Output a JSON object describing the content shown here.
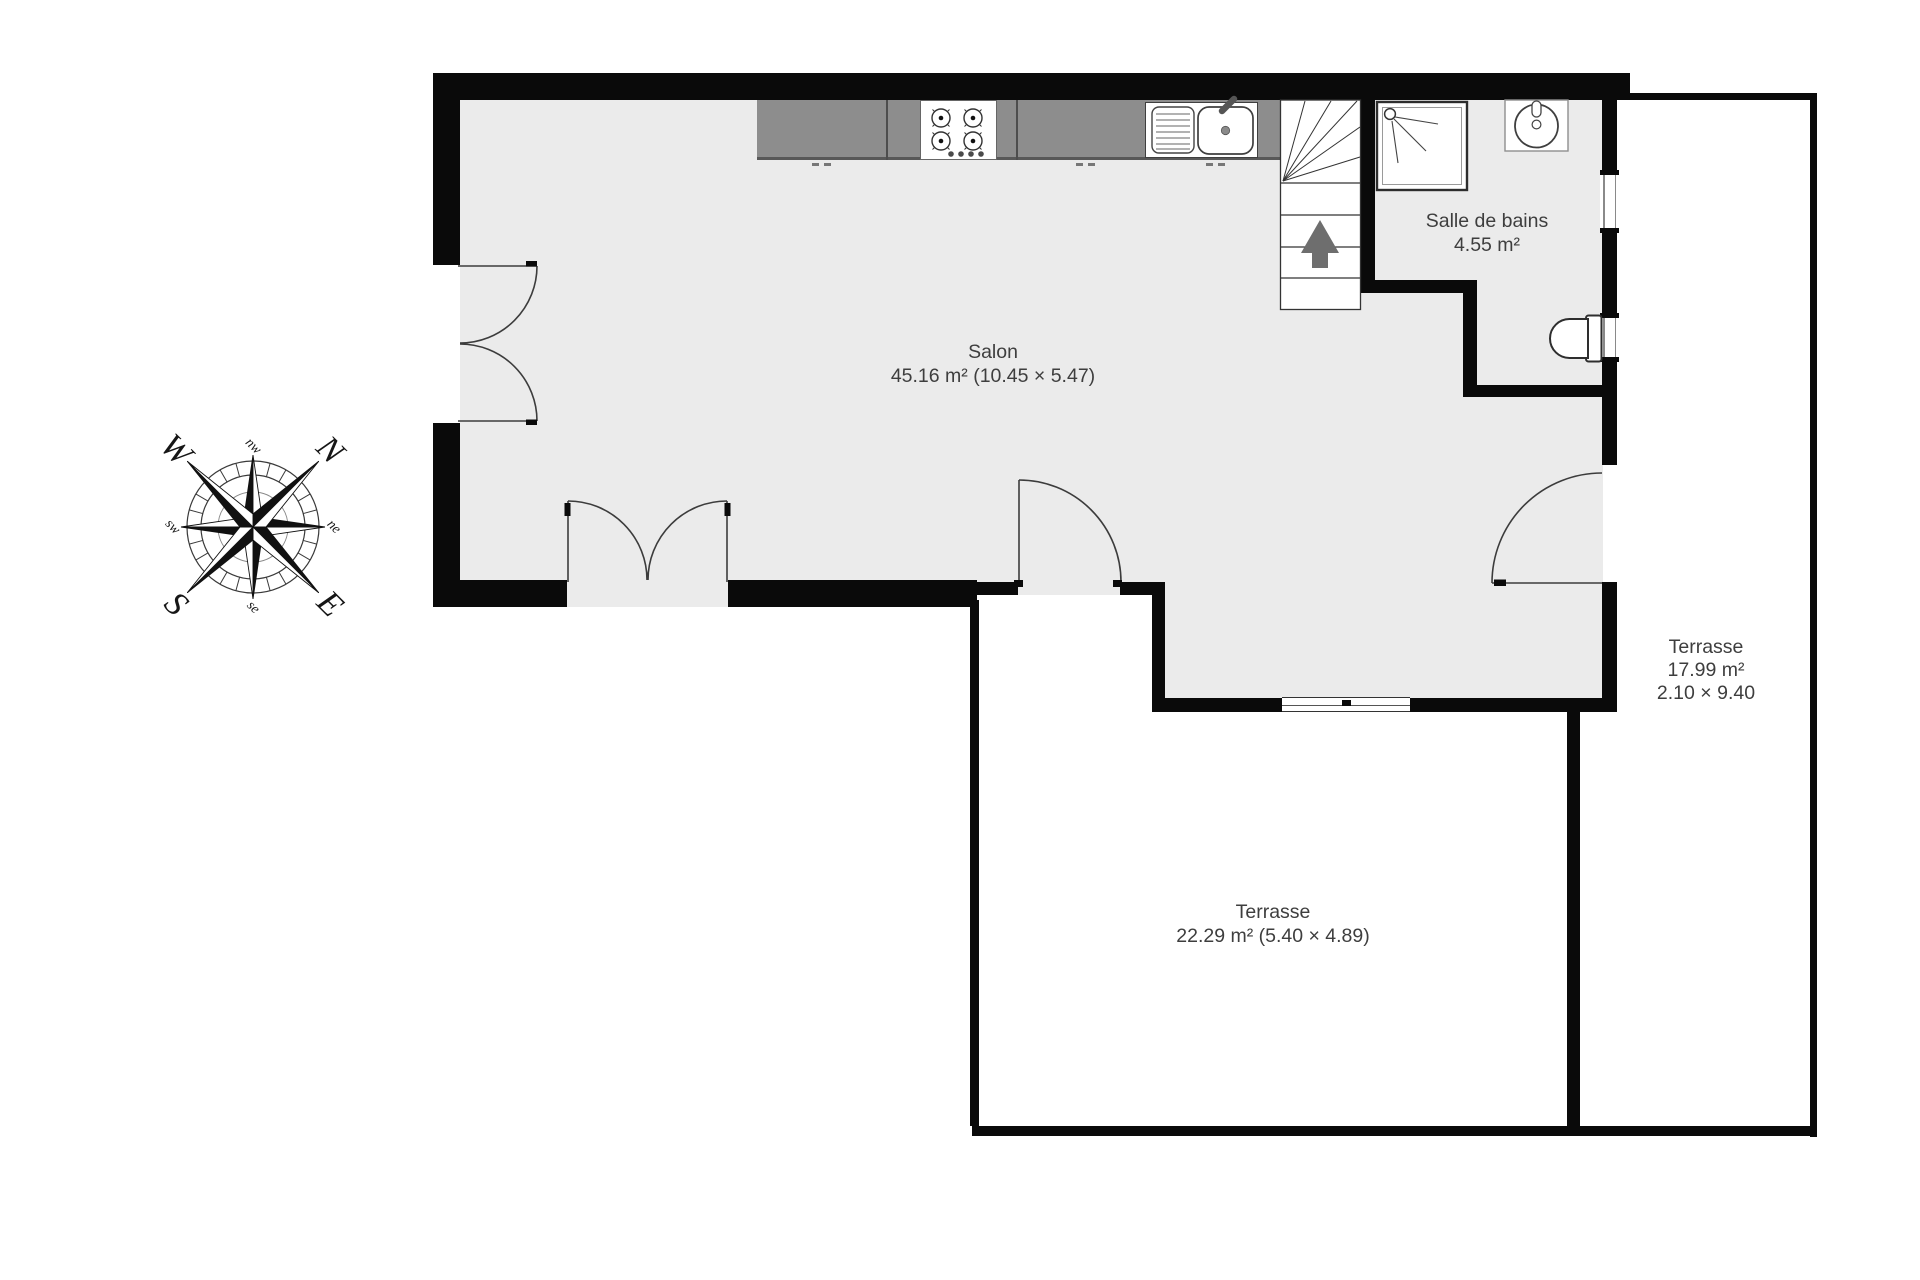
{
  "plan_title": "Floor plan",
  "rooms": {
    "salon": {
      "label": "Salon",
      "area_line": "45.16 m² (10.45 × 5.47)"
    },
    "bathroom": {
      "label": "Salle de bains",
      "area_line": "4.55 m²"
    },
    "terrace_right": {
      "label": "Terrasse",
      "area_line": "17.99 m²",
      "dims_line": "2.10 × 9.40"
    },
    "terrace_bottom": {
      "label": "Terrasse",
      "area_line": "22.29 m² (5.40 × 4.89)"
    }
  },
  "compass": {
    "cardinals": {
      "n": "N",
      "e": "E",
      "s": "S",
      "w": "W"
    },
    "intercardinals": {
      "ne": "ne",
      "se": "se",
      "sw": "sw",
      "nw": "nw"
    }
  },
  "fixtures": [
    "kitchen-counter",
    "stove-4-burners",
    "kitchen-sink-drainer",
    "stairs-up",
    "shower",
    "washbasin",
    "toilet",
    "french-door",
    "single-door",
    "window",
    "sliding-window"
  ],
  "colors": {
    "wall": "#0a0a0a",
    "floor": "#ebebeb",
    "counter": "#8d8d8d",
    "text": "#3e3e3e",
    "fixture_outline": "#3c3c3c",
    "arrow": "#6e6e6e",
    "background": "#ffffff"
  }
}
